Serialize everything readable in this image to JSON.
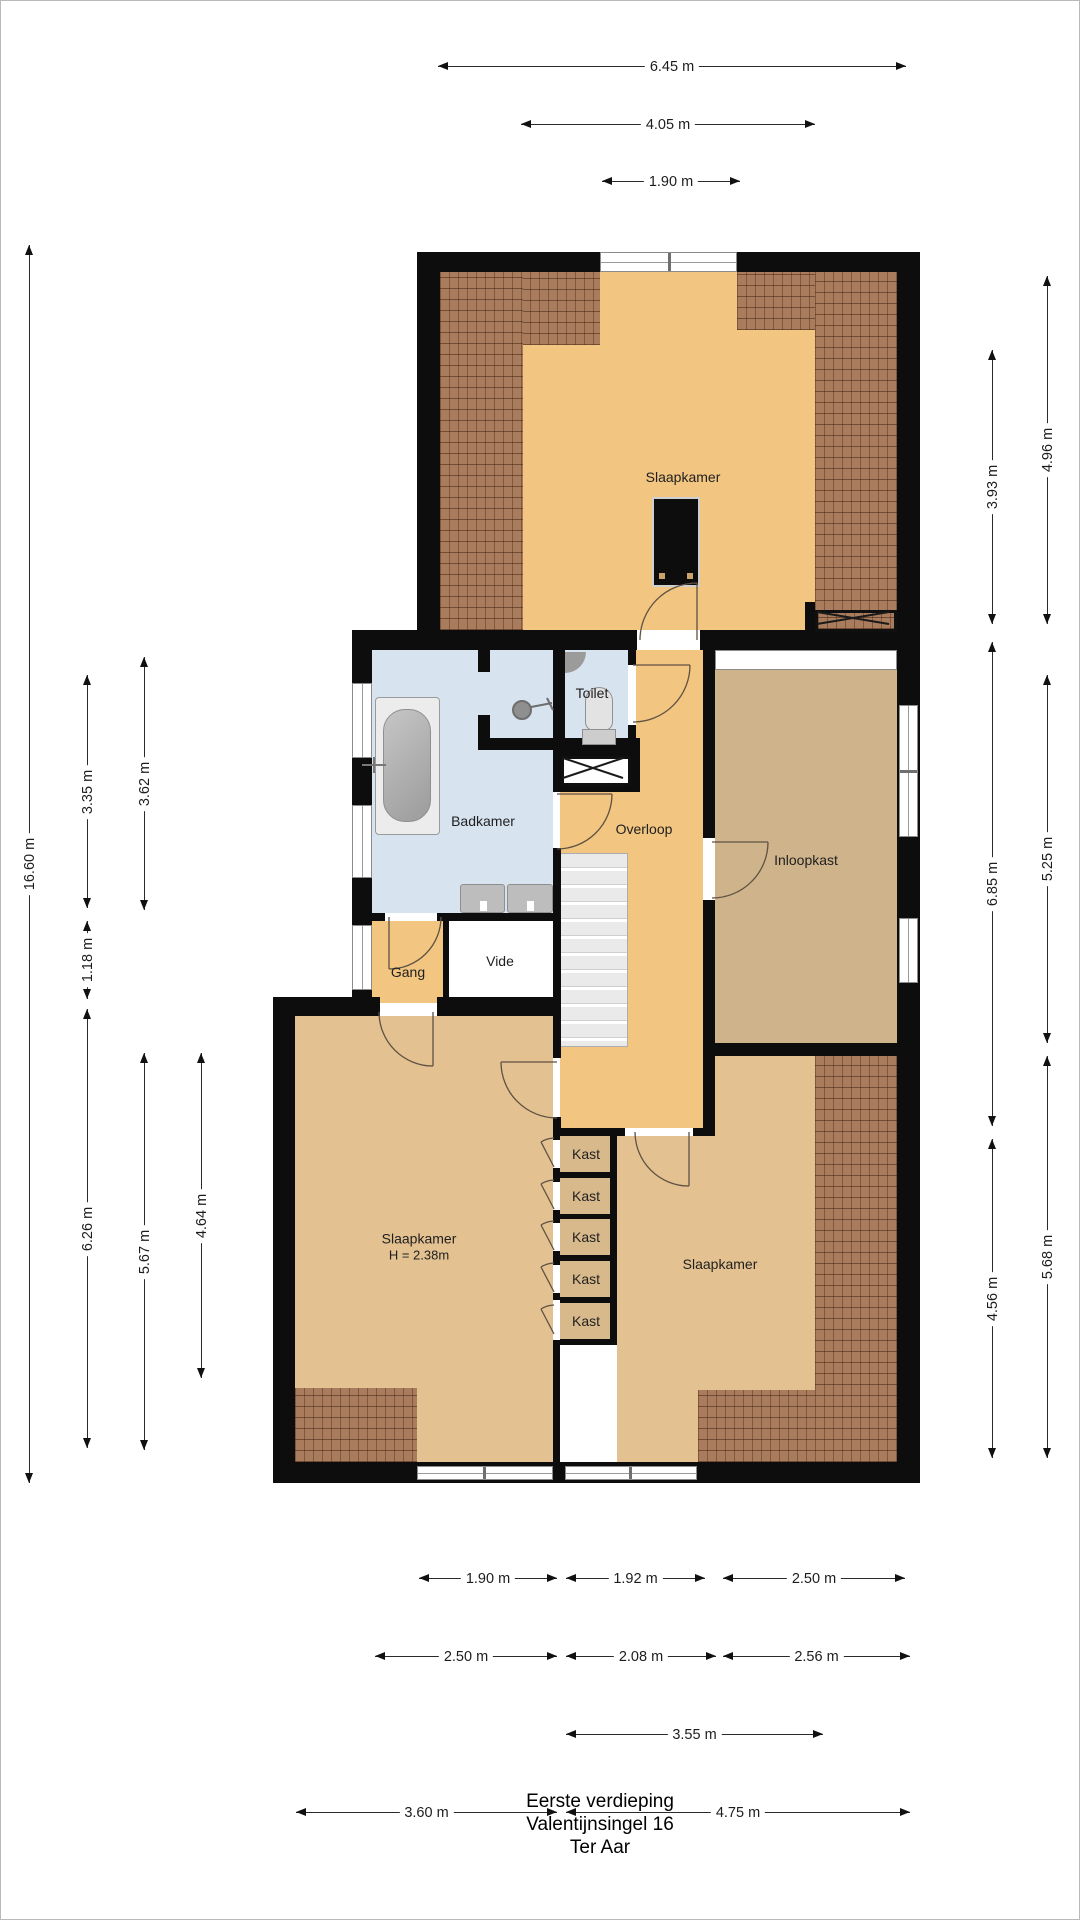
{
  "plan": {
    "title": [
      "Eerste verdieping",
      "Valentijnsingel 16",
      "Ter Aar"
    ],
    "rooms": [
      {
        "id": "slaapkamer-boven",
        "label": "Slaapkamer",
        "x": 683,
        "y": 477
      },
      {
        "id": "badkamer",
        "label": "Badkamer",
        "x": 483,
        "y": 821
      },
      {
        "id": "toilet",
        "label": "Toilet",
        "x": 592,
        "y": 693
      },
      {
        "id": "overloop",
        "label": "Overloop",
        "x": 644,
        "y": 829
      },
      {
        "id": "inloopkast",
        "label": "Inloopkast",
        "x": 806,
        "y": 860
      },
      {
        "id": "vide",
        "label": "Vide",
        "x": 500,
        "y": 961
      },
      {
        "id": "gang",
        "label": "Gang",
        "x": 408,
        "y": 972
      },
      {
        "id": "slaapkamer-links",
        "label": "Slaapkamer",
        "sublabel": "H = 2.38m",
        "x": 419,
        "y": 1247
      },
      {
        "id": "slaapkamer-rechts",
        "label": "Slaapkamer",
        "x": 720,
        "y": 1264
      },
      {
        "id": "kast-1",
        "label": "Kast",
        "x": 586,
        "y": 1154
      },
      {
        "id": "kast-2",
        "label": "Kast",
        "x": 586,
        "y": 1196
      },
      {
        "id": "kast-3",
        "label": "Kast",
        "x": 586,
        "y": 1237
      },
      {
        "id": "kast-4",
        "label": "Kast",
        "x": 586,
        "y": 1279
      },
      {
        "id": "kast-5",
        "label": "Kast",
        "x": 586,
        "y": 1321
      }
    ],
    "dimensions": {
      "horizontal": [
        {
          "label": "6.45 m",
          "x1": 438,
          "x2": 906,
          "y": 67
        },
        {
          "label": "4.05 m",
          "x1": 521,
          "x2": 815,
          "y": 125
        },
        {
          "label": "1.90 m",
          "x1": 602,
          "x2": 740,
          "y": 182
        },
        {
          "label": "1.90 m",
          "x1": 419,
          "x2": 557,
          "y": 1579
        },
        {
          "label": "1.92 m",
          "x1": 566,
          "x2": 705,
          "y": 1579
        },
        {
          "label": "2.50 m",
          "x1": 723,
          "x2": 905,
          "y": 1579
        },
        {
          "label": "2.50 m",
          "x1": 375,
          "x2": 557,
          "y": 1657
        },
        {
          "label": "2.08 m",
          "x1": 566,
          "x2": 716,
          "y": 1657
        },
        {
          "label": "2.56 m",
          "x1": 723,
          "x2": 910,
          "y": 1657
        },
        {
          "label": "3.55 m",
          "x1": 566,
          "x2": 823,
          "y": 1735
        },
        {
          "label": "3.60 m",
          "x1": 296,
          "x2": 557,
          "y": 1813
        },
        {
          "label": "4.75 m",
          "x1": 566,
          "x2": 910,
          "y": 1813
        }
      ],
      "vertical": [
        {
          "label": "16.60 m",
          "x": 30,
          "y1": 245,
          "y2": 1483
        },
        {
          "label": "3.35 m",
          "x": 88,
          "y1": 675,
          "y2": 908
        },
        {
          "label": "1.18 m",
          "x": 88,
          "y1": 921,
          "y2": 999
        },
        {
          "label": "6.26 m",
          "x": 88,
          "y1": 1009,
          "y2": 1448
        },
        {
          "label": "3.62 m",
          "x": 145,
          "y1": 657,
          "y2": 910
        },
        {
          "label": "5.67 m",
          "x": 145,
          "y1": 1053,
          "y2": 1450
        },
        {
          "label": "4.64 m",
          "x": 202,
          "y1": 1053,
          "y2": 1378
        },
        {
          "label": "3.93 m",
          "x": 993,
          "y1": 350,
          "y2": 624
        },
        {
          "label": "6.85 m",
          "x": 993,
          "y1": 642,
          "y2": 1126
        },
        {
          "label": "4.56 m",
          "x": 993,
          "y1": 1139,
          "y2": 1458
        },
        {
          "label": "4.96 m",
          "x": 1048,
          "y1": 276,
          "y2": 624
        },
        {
          "label": "5.25 m",
          "x": 1048,
          "y1": 675,
          "y2": 1043
        },
        {
          "label": "5.68 m",
          "x": 1048,
          "y1": 1056,
          "y2": 1458
        }
      ]
    },
    "colors": {
      "floor_orange": "#F2C581",
      "floor_tan": "#E3C190",
      "floor_walkin": "#CFB38A",
      "floor_closet": "#D8B98B",
      "floor_bath": "#D7E3EF",
      "wall": "#0d0d0d",
      "roof_hatch": "#a87c5c"
    }
  }
}
